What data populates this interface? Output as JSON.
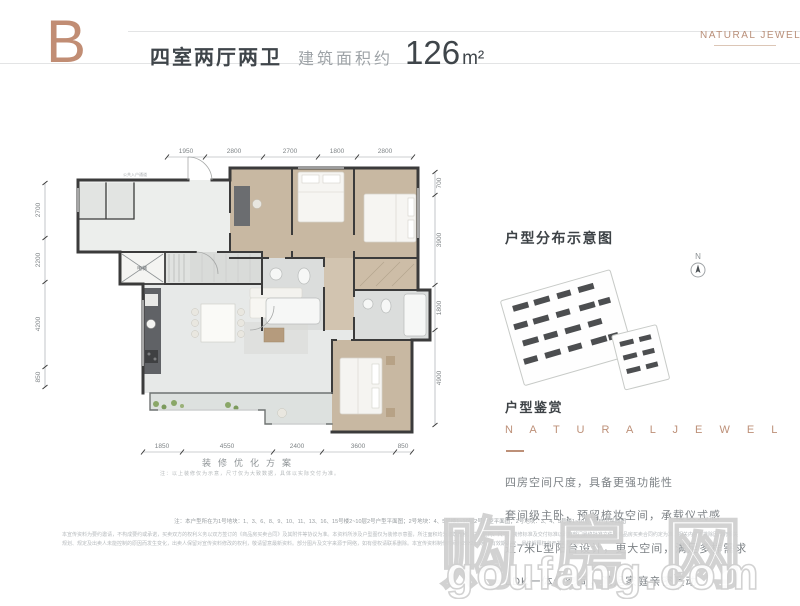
{
  "header": {
    "block_letter": "B",
    "layout_title": "四室两厅两卫",
    "area_label": "建筑面积约",
    "area_value": "126",
    "area_unit": "m²",
    "brand_logo": "NATURAL JEWEL"
  },
  "floor_plan": {
    "corridor_label": "公共入户通道",
    "elevator_label": "电梯",
    "dims_top": [
      "1950",
      "2800",
      "2700",
      "1800",
      "2800"
    ],
    "dims_left": [
      "2700",
      "2200",
      "4200",
      "850"
    ],
    "dims_right": [
      "700",
      "3900",
      "1800",
      "4900"
    ],
    "dims_bottom": [
      "1850",
      "4550",
      "2400",
      "3600",
      "850"
    ],
    "caption": "装修优化方案",
    "caption_note": "注：以上装修仅为示意，尺寸仅为大致数据，具体以实际交付为准。"
  },
  "side_panel": {
    "distribution_title": "户型分布示意图",
    "compass_label": "N",
    "appreciation_title": "户型鉴赏",
    "brand_text": "N A T U R A L   J E W E L",
    "features": [
      "四房空间尺度，具备更强功能性",
      "套间级主卧，预留梳妆空间，承载仪式感",
      "近7米L型阳台设计，更大空间，满足多样需求",
      "LDK一体化空间，满足家庭亲密互动"
    ]
  },
  "footer": {
    "note_line": "注：本户型所在为1号地块：1、3、6、8、9、10、11、13、16、15号楼2~10层2号户型平面图；2号地块：4、5号楼1~10层2号户型平面图；2号地块：3、4、5号楼1~10层2号户型平面图",
    "disclaimer": "本宣传资料为要约邀请，不构成要约或承诺，买卖双方的权利义务以双方签订的《商品房买卖合同》及其附件等协议为准。本资料所涉及户型图仅为装修示意图，所注面积均为建筑面积，户型结构、尺寸、装修标准及交付标准以政府部门最终批准文件及商品房买卖合同约定为准。相关内容不排除因政府相关规划、规定及出卖人未能控制的原因而发生变化，出卖人保留对宣传资料修改的权利，敬请留意最新资料。部分图片及文字来源于网络，如有侵权请联系删除。本宣传资料制作时间为2022年1月，有效期30天，最终解释权归开发商所有。"
  },
  "watermark": {
    "site_name": "购房网",
    "site_domain": "goufang.com"
  },
  "colors": {
    "accent_copper": "#bd8b72",
    "title_dark": "#42474c",
    "wall": "#3b3b3b",
    "wood_floor": "#c8b8a2",
    "tile_floor": "#e7e9e8"
  }
}
